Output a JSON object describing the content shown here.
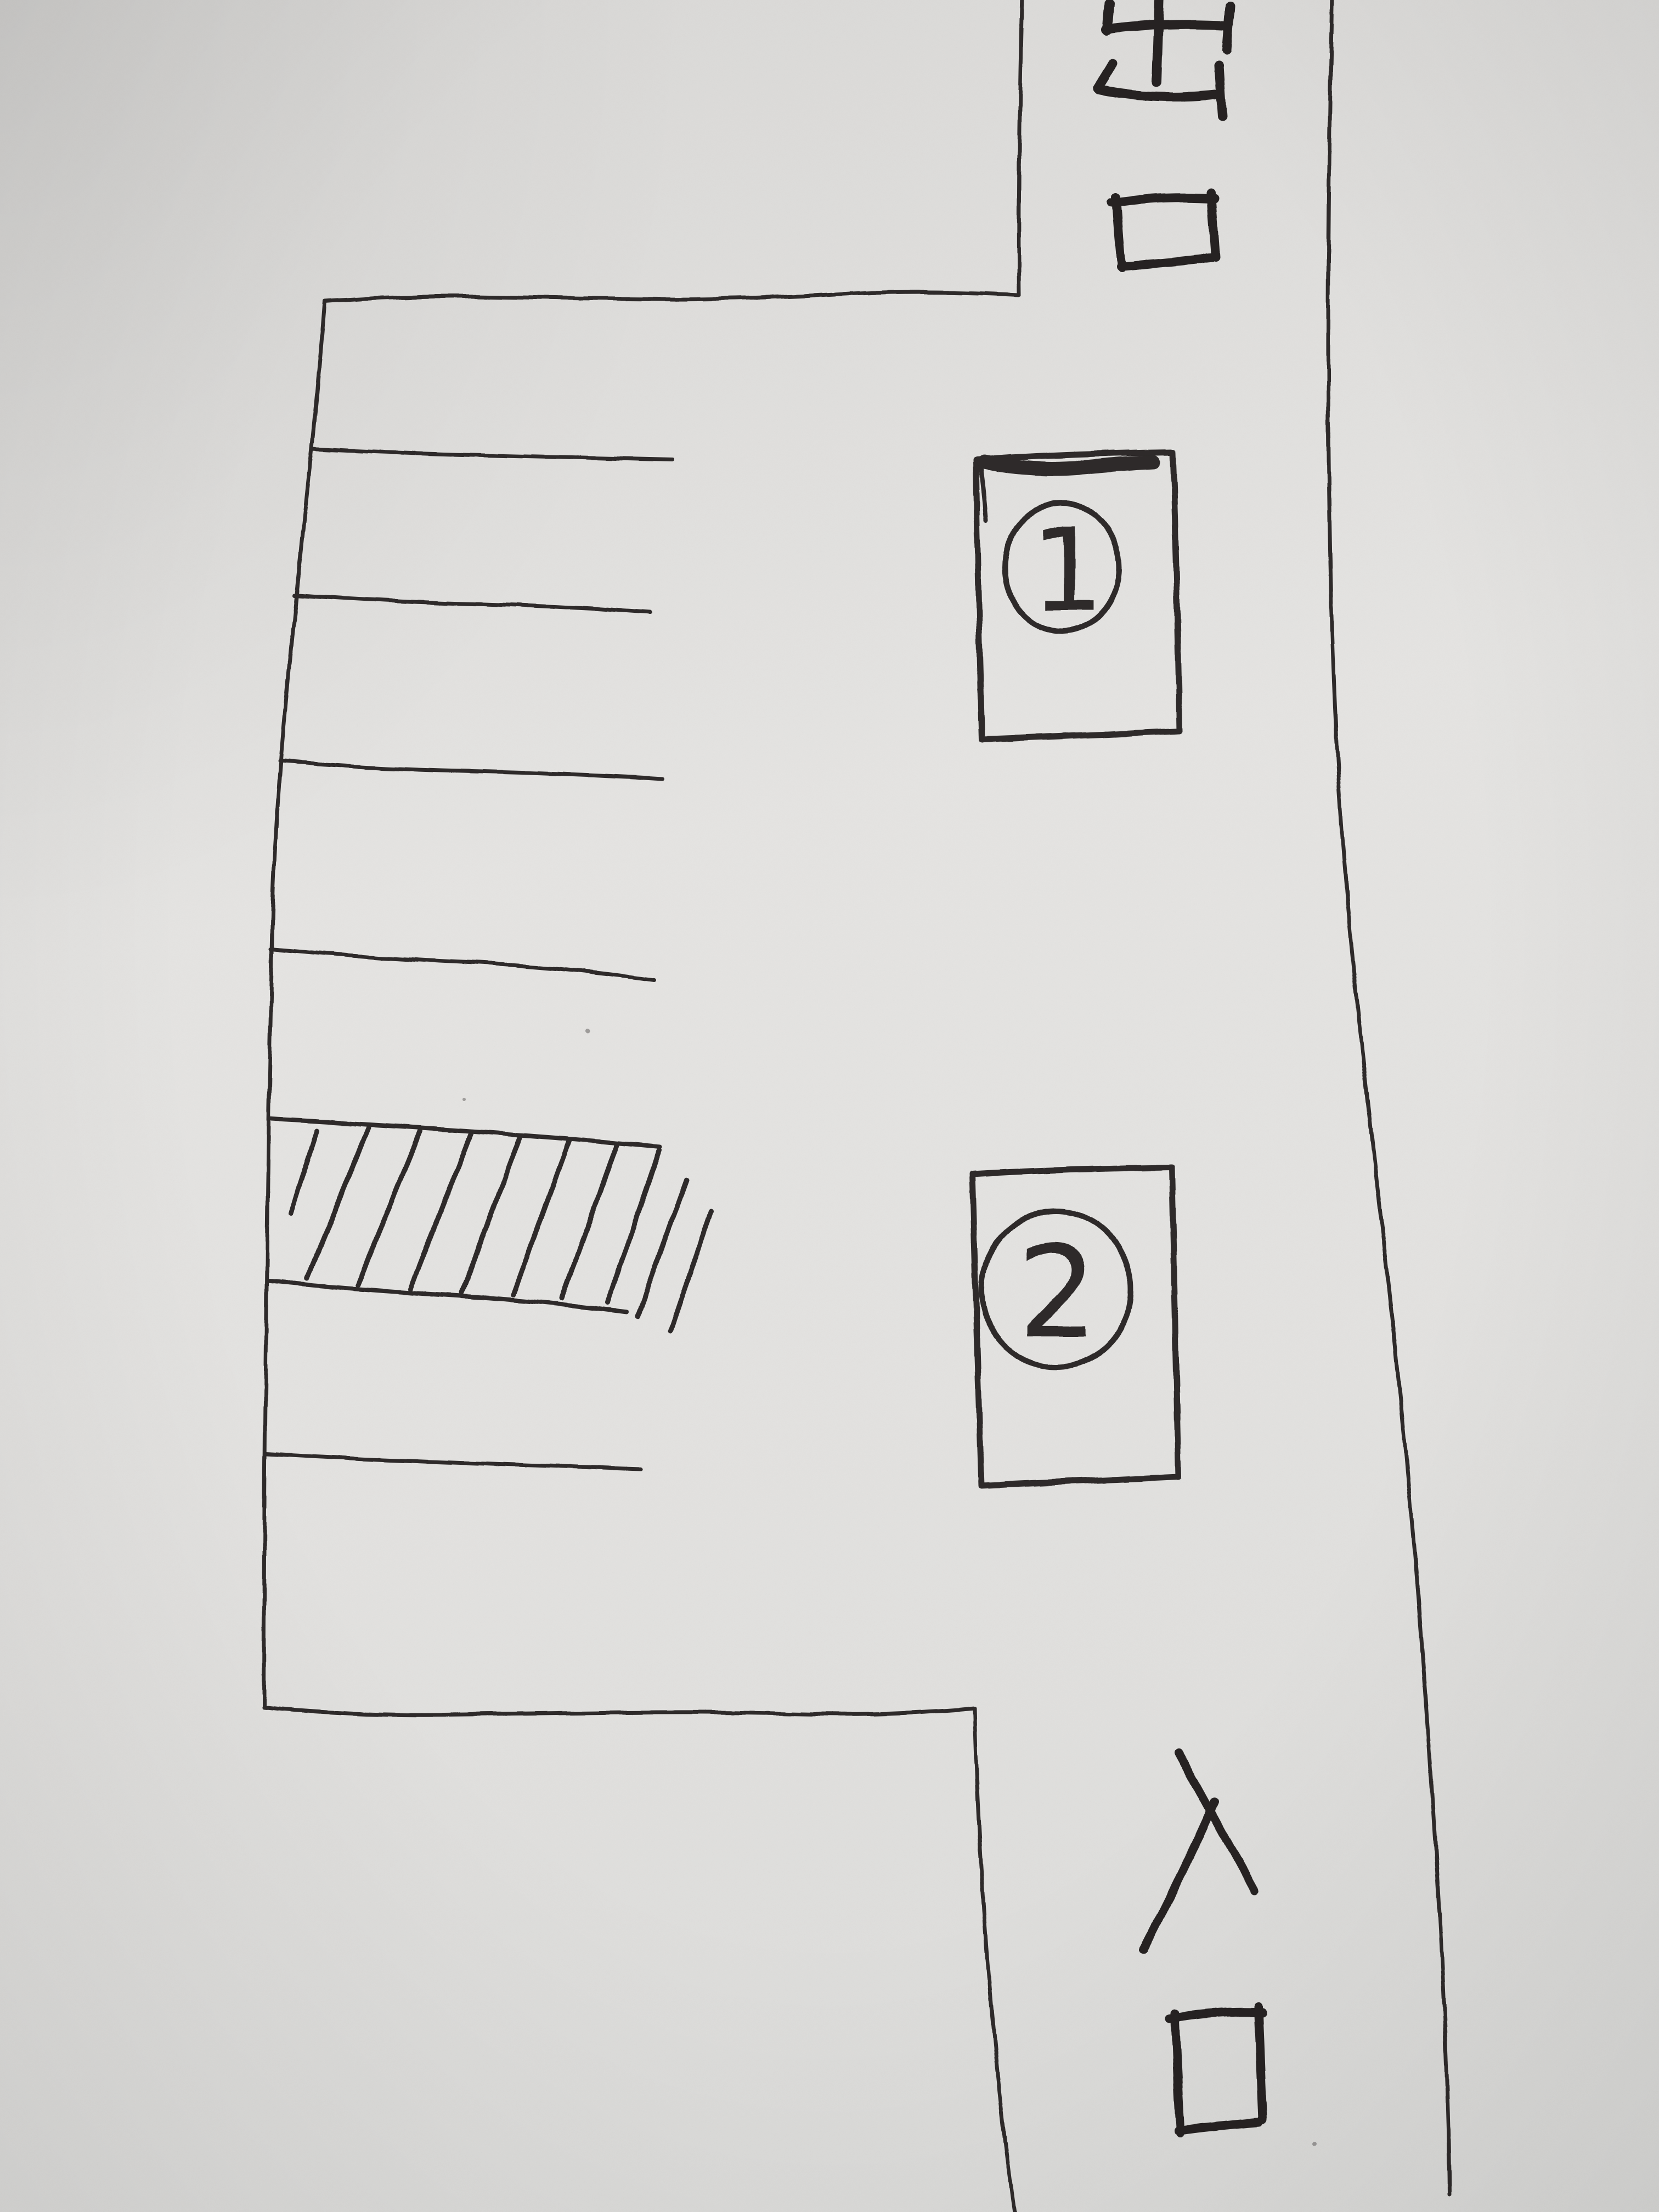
{
  "figure": {
    "type": "hand-drawn parking lot map, pen on paper",
    "paper_color": "#e2e1df",
    "ink_color": "#2d2b29"
  },
  "road": {
    "exit_label": "出口",
    "exit_char_top": "出",
    "exit_char_bottom": "口",
    "entrance_label": "入口",
    "entrance_char_top": "入",
    "entrance_char_bottom": "口"
  },
  "markers": [
    {
      "number": "1"
    },
    {
      "number": "2"
    }
  ],
  "lot": {
    "horizontal_divider_count": 7,
    "hatch_stroke_count": 10
  }
}
